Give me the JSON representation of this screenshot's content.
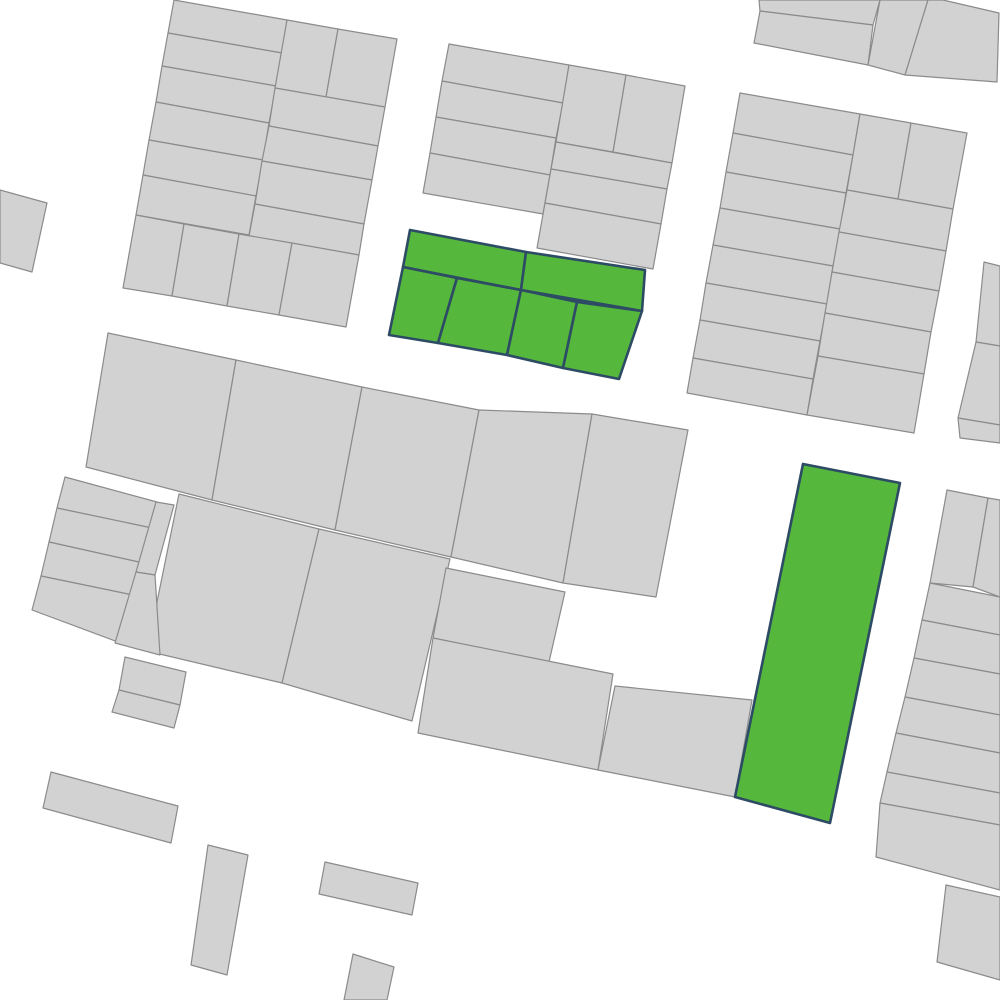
{
  "map": {
    "width": 1000,
    "height": 1000,
    "background_color": "#ffffff",
    "parcel_fill": "#d2d2d3",
    "parcel_stroke": "#8b8b8b",
    "parcel_stroke_width": 1.2,
    "highlight_fill": "#55b83c",
    "highlight_stroke": "#2d4b64",
    "highlight_stroke_width": 2.6,
    "parcels": [
      {
        "id": "parcel-nw-l1",
        "highlight": false,
        "points": "174,0 287,20 282,53 168,33"
      },
      {
        "id": "parcel-nw-l2",
        "highlight": false,
        "points": "168,33 282,53 276,86 162,66"
      },
      {
        "id": "parcel-nw-l3",
        "highlight": false,
        "points": "162,66 276,86 269,123 156,102"
      },
      {
        "id": "parcel-nw-l4",
        "highlight": false,
        "points": "156,102 269,123 263,160 149,140"
      },
      {
        "id": "parcel-nw-l5",
        "highlight": false,
        "points": "149,140 263,160 256,196 143,175"
      },
      {
        "id": "parcel-nw-l6",
        "highlight": false,
        "points": "143,175 256,196 249,235 136,215"
      },
      {
        "id": "parcel-nw-rp1",
        "highlight": false,
        "points": "287,20 338,29 326,97 275,88"
      },
      {
        "id": "parcel-nw-rp2",
        "highlight": false,
        "points": "338,29 397,39 385,107 326,97"
      },
      {
        "id": "parcel-nw-rr1",
        "highlight": false,
        "points": "275,88 385,107 378,146 269,126"
      },
      {
        "id": "parcel-nw-rr2",
        "highlight": false,
        "points": "269,126 378,146 372,180 262,161"
      },
      {
        "id": "parcel-nw-rr3",
        "highlight": false,
        "points": "262,161 372,180 364,224 255,204"
      },
      {
        "id": "parcel-nw-rr4",
        "highlight": false,
        "points": "255,204 364,224 359,255 249,236"
      },
      {
        "id": "parcel-nw-b1",
        "highlight": false,
        "points": "136,215 184,224 172,296 123,288"
      },
      {
        "id": "parcel-nw-b2",
        "highlight": false,
        "points": "184,224 239,234 227,306 172,296"
      },
      {
        "id": "parcel-nw-b3",
        "highlight": false,
        "points": "239,234 292,243 279,315 227,306"
      },
      {
        "id": "parcel-nw-b4",
        "highlight": false,
        "points": "292,243 359,255 346,327 279,315"
      },
      {
        "id": "parcel-n-l1",
        "highlight": false,
        "points": "449,44 569,65 563,103 442,81"
      },
      {
        "id": "parcel-n-l2",
        "highlight": false,
        "points": "442,81 563,103 556,138 436,117"
      },
      {
        "id": "parcel-n-l3",
        "highlight": false,
        "points": "436,117 556,138 550,175 430,153"
      },
      {
        "id": "parcel-n-l4",
        "highlight": false,
        "points": "430,153 550,175 543,214 423,193"
      },
      {
        "id": "parcel-n-rp1",
        "highlight": false,
        "points": "569,65 626,75 613,152 556,142"
      },
      {
        "id": "parcel-n-rp2",
        "highlight": false,
        "points": "626,75 685,86 672,163 613,152"
      },
      {
        "id": "parcel-n-rr1",
        "highlight": false,
        "points": "556,142 672,163 667,189 551,169"
      },
      {
        "id": "parcel-n-rr2",
        "highlight": false,
        "points": "551,169 667,189 661,224 545,203"
      },
      {
        "id": "parcel-n-rr3",
        "highlight": false,
        "points": "545,203 661,224 653,269 537,248"
      },
      {
        "id": "parcel-ne-a",
        "highlight": false,
        "points": "759,0 880,0 873,25 760,11"
      },
      {
        "id": "parcel-ne-b",
        "highlight": false,
        "points": "760,11 873,25 868,65 754,43"
      },
      {
        "id": "parcel-ne-c",
        "highlight": false,
        "points": "880,0 928,0 905,75 868,65"
      },
      {
        "id": "parcel-ne-d",
        "highlight": false,
        "points": "928,0 943,0 999,13 997,82 905,75"
      },
      {
        "id": "parcel-e-l1",
        "highlight": false,
        "points": "740,93 860,114 853,155 733,133"
      },
      {
        "id": "parcel-e-l2",
        "highlight": false,
        "points": "733,133 853,155 846,193 726,172"
      },
      {
        "id": "parcel-e-l3",
        "highlight": false,
        "points": "726,172 846,193 840,229 720,208"
      },
      {
        "id": "parcel-e-l4",
        "highlight": false,
        "points": "720,208 840,229 833,266 713,245"
      },
      {
        "id": "parcel-e-l5",
        "highlight": false,
        "points": "713,245 833,266 827,304 706,283"
      },
      {
        "id": "parcel-e-l6",
        "highlight": false,
        "points": "706,283 827,304 820,341 700,320"
      },
      {
        "id": "parcel-e-l7",
        "highlight": false,
        "points": "700,320 820,341 813,379 693,358"
      },
      {
        "id": "parcel-e-l8",
        "highlight": false,
        "points": "693,358 813,379 807,415 687,393"
      },
      {
        "id": "parcel-e-rp1",
        "highlight": false,
        "points": "860,114 911,123 898,199 847,190"
      },
      {
        "id": "parcel-e-rp2",
        "highlight": false,
        "points": "911,123 967,133 953,209 898,199"
      },
      {
        "id": "parcel-e-rr1",
        "highlight": false,
        "points": "847,190 953,209 946,251 839,232"
      },
      {
        "id": "parcel-e-rr2",
        "highlight": false,
        "points": "839,232 946,251 939,291 832,272"
      },
      {
        "id": "parcel-e-rr3",
        "highlight": false,
        "points": "832,272 939,291 931,332 825,313"
      },
      {
        "id": "parcel-e-rr4",
        "highlight": false,
        "points": "825,313 931,332 924,374 818,356"
      },
      {
        "id": "parcel-e-rr5",
        "highlight": false,
        "points": "818,356 924,374 914,433 807,415"
      },
      {
        "id": "parcel-mid-1",
        "highlight": false,
        "points": "108,333 236,360 212,500 86,467"
      },
      {
        "id": "parcel-mid-2",
        "highlight": false,
        "points": "236,360 362,387 335,530 212,500"
      },
      {
        "id": "parcel-mid-3",
        "highlight": false,
        "points": "362,387 479,410 451,557 335,530"
      },
      {
        "id": "parcel-mid-4",
        "highlight": false,
        "points": "479,410 592,414 563,583 451,557"
      },
      {
        "id": "parcel-mid-5",
        "highlight": false,
        "points": "592,414 688,430 656,597 563,583"
      },
      {
        "id": "parcel-sw-sq1",
        "highlight": false,
        "points": "179,494 319,529 282,683 147,651"
      },
      {
        "id": "parcel-sw-sq2",
        "highlight": false,
        "points": "319,529 450,559 412,721 282,683"
      },
      {
        "id": "parcel-w-r1",
        "highlight": false,
        "points": "65,477 157,502 152,528 57,508"
      },
      {
        "id": "parcel-w-r2",
        "highlight": false,
        "points": "57,508 152,528 143,563 49,542"
      },
      {
        "id": "parcel-w-r3",
        "highlight": false,
        "points": "49,542 143,563 133,595 41,576"
      },
      {
        "id": "parcel-w-r4",
        "highlight": false,
        "points": "41,576 133,595 118,642 32,610"
      },
      {
        "id": "parcel-w-sliver1",
        "highlight": false,
        "points": "156,502 174,505 155,575 136,572"
      },
      {
        "id": "parcel-w-sliver2",
        "highlight": false,
        "points": "136,572 155,575 160,655 115,643"
      },
      {
        "id": "parcel-w-flag1",
        "highlight": false,
        "points": "125,657 186,672 180,705 119,690"
      },
      {
        "id": "parcel-w-flag2",
        "highlight": false,
        "points": "119,690 180,705 174,728 112,712"
      },
      {
        "id": "parcel-w-edge",
        "highlight": false,
        "points": "0,190 47,203 32,272 0,263"
      },
      {
        "id": "parcel-s-a",
        "highlight": false,
        "points": "446,568 565,592 549,662 433,638"
      },
      {
        "id": "parcel-s-b",
        "highlight": false,
        "points": "433,638 613,674 598,770 418,733"
      },
      {
        "id": "parcel-s-c",
        "highlight": false,
        "points": "615,686 752,700 735,797 598,770"
      },
      {
        "id": "parcel-se-p1",
        "highlight": false,
        "points": "947,490 988,498 973,587 930,583"
      },
      {
        "id": "parcel-se-p2",
        "highlight": false,
        "points": "988,498 1000,500 1000,597 973,587"
      },
      {
        "id": "parcel-se-r1",
        "highlight": false,
        "points": "930,583 1000,597 1000,635 922,620"
      },
      {
        "id": "parcel-se-r2",
        "highlight": false,
        "points": "922,620 1000,635 1000,674 914,658"
      },
      {
        "id": "parcel-se-r3",
        "highlight": false,
        "points": "914,658 1000,674 1000,715 905,697"
      },
      {
        "id": "parcel-se-r4",
        "highlight": false,
        "points": "905,697 1000,715 1000,753 896,733"
      },
      {
        "id": "parcel-se-r5",
        "highlight": false,
        "points": "896,733 1000,753 1000,793 887,772"
      },
      {
        "id": "parcel-se-r6",
        "highlight": false,
        "points": "887,772 1000,793 1000,825 880,803"
      },
      {
        "id": "parcel-se-r7",
        "highlight": false,
        "points": "880,803 1000,825 1000,890 876,857"
      },
      {
        "id": "parcel-er-1",
        "highlight": false,
        "points": "984,262 1000,266 1000,346 976,342"
      },
      {
        "id": "parcel-er-2",
        "highlight": false,
        "points": "976,342 1000,346 1000,425 958,418"
      },
      {
        "id": "parcel-er-3",
        "highlight": false,
        "points": "958,418 1000,425 1000,443 960,438"
      },
      {
        "id": "parcel-bar-a",
        "highlight": false,
        "points": "51,772 178,806 171,843 43,808"
      },
      {
        "id": "parcel-bar-b",
        "highlight": false,
        "points": "208,845 248,855 227,975 191,965"
      },
      {
        "id": "parcel-bar-c",
        "highlight": false,
        "points": "325,862 418,883 412,915 319,894"
      },
      {
        "id": "parcel-bar-d",
        "highlight": false,
        "points": "353,954 394,967 387,1000 344,1000"
      },
      {
        "id": "parcel-se-corner",
        "highlight": false,
        "points": "946,885 1000,897 1000,980 937,962"
      },
      {
        "id": "highlight-parcel-a1",
        "highlight": true,
        "points": "410,230 526,252 521,290 403,267"
      },
      {
        "id": "highlight-parcel-a2",
        "highlight": true,
        "points": "526,252 645,270 642,311 521,290"
      },
      {
        "id": "highlight-parcel-a3",
        "highlight": true,
        "points": "403,267 457,278 438,343 389,335"
      },
      {
        "id": "highlight-parcel-a4",
        "highlight": true,
        "points": "457,278 521,290 507,355 438,343"
      },
      {
        "id": "highlight-parcel-a5",
        "highlight": true,
        "points": "521,290 577,302 563,368 507,355"
      },
      {
        "id": "highlight-parcel-a6",
        "highlight": true,
        "points": "577,302 642,311 619,379 563,368"
      },
      {
        "id": "highlight-parcel-b",
        "highlight": true,
        "points": "803,464 900,483 830,823 735,797"
      }
    ]
  }
}
